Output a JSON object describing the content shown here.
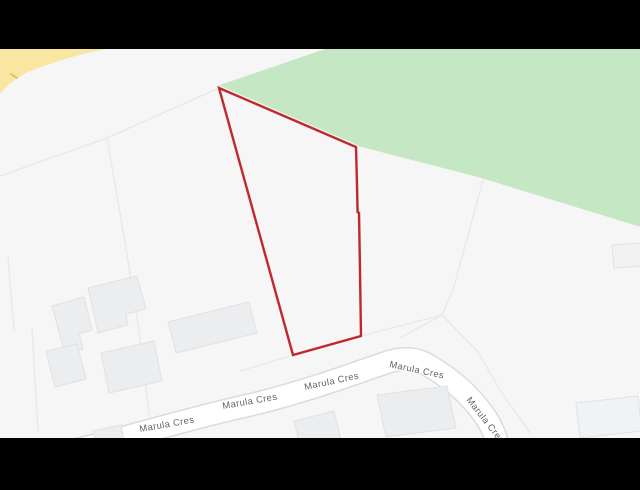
{
  "window": {
    "width": 640,
    "height": 490,
    "letterbox_color": "#000000"
  },
  "map": {
    "kind": "road-map-light-theme",
    "background_color": "#F6F6F7",
    "viewport": {
      "x": 0,
      "y": 49,
      "width": 640,
      "height": 389
    },
    "park_area": {
      "name": "green-park-area",
      "fill": "#C5E7C4",
      "points": "217,86 325,49 644,49 644,228 478,177 354,145"
    },
    "yellow_road": {
      "name": "yellow-main-road",
      "fill": "#F9E6A0",
      "path": "M0,49 L106,49 Q62,58 28,72 Q10,81 0,94 Z",
      "mark_path": "M11,74 L17,78",
      "mark_color": "#E3C35E"
    },
    "parcel_lines": {
      "stroke": "#E7E8EA",
      "width": 1.3,
      "paths": [
        "M219,88 L107,138 L0,176",
        "M107,138 L126,248 L139,330 L150,421",
        "M8,257 L14,330",
        "M32,328 L38,431",
        "M483,180 L453,290 L442,315",
        "M442,315 L400,338",
        "M442,315 L478,352 L500,390 L530,433",
        "M361,336 L442,315",
        "M293,355 L240,371"
      ]
    },
    "road": {
      "name": "Marula Cres",
      "casing_color": "#DADCDE",
      "fill_color": "#FFFFFF",
      "casing_width": 24,
      "fill_width": 21,
      "path": "M52,456 C120,440 185,419 250,405 C300,393 345,377 385,363 C405,356 418,359 428,365 C450,378 466,392 478,407 C488,419 496,433 499,450"
    },
    "road_labels": {
      "color": "#5F6266",
      "halo": "#FFFFFF",
      "items": [
        {
          "text": "Marula Cres",
          "x": 140,
          "y": 432,
          "rotate": -10
        },
        {
          "text": "Marula Cres",
          "x": 223,
          "y": 409,
          "rotate": -10
        },
        {
          "text": "Marula Cres",
          "x": 305,
          "y": 390,
          "rotate": -12
        },
        {
          "text": "Marula Cres",
          "x": 389,
          "y": 367,
          "rotate": 12
        },
        {
          "text": "Marula Cres",
          "x": 466,
          "y": 400,
          "rotate": 52
        }
      ]
    },
    "buildings": {
      "fill": "#ECEDEE",
      "stroke": "#E0E1E3",
      "items": [
        {
          "points": "52,306 84,297 92,330 79,334 83,349 65,354"
        },
        {
          "points": "88,288 137,276 146,309 126,314 128,325 98,333"
        },
        {
          "points": "46,351 77,344 86,379 55,387"
        },
        {
          "points": "101,353 154,341 162,381 109,393"
        },
        {
          "points": "168,322 249,302 257,333 176,353"
        },
        {
          "points": "612,245 641,243 643,266 614,268",
          "fill": "#F1F2F3"
        },
        {
          "points": "576,403 638,396 642,431 580,438",
          "fill": "#F1F2F3"
        },
        {
          "points": "377,395 447,386 456,428 386,437"
        },
        {
          "points": "93,431 121,425 124,440 96,445"
        },
        {
          "points": "294,421 334,411 341,440 301,449"
        }
      ]
    },
    "property_boundary": {
      "name": "highlighted-parcel-outline",
      "stroke": "#BE2832",
      "halo": "#F7F5EE",
      "width": 2.4,
      "halo_width": 5,
      "points": "219,88 356,147 357,185 357.6,212 359,213 360,270 361,336 293,355"
    }
  }
}
